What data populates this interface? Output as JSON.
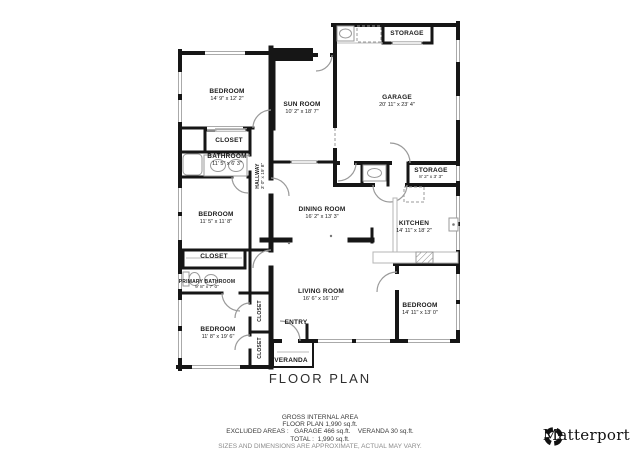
{
  "title": "FLOOR PLAN",
  "rooms": [
    {
      "name": "BEDROOM",
      "dims": "14' 9\" x 12' 2\""
    },
    {
      "name": "SUN ROOM",
      "dims": "10' 2\" x 18' 7\""
    },
    {
      "name": "GARAGE",
      "dims": "20' 11\" x 23' 4\""
    },
    {
      "name": "STORAGE",
      "dims": ""
    },
    {
      "name": "CLOSET",
      "dims": ""
    },
    {
      "name": "BATHROOM",
      "dims": "11' 5\" x 6' 3\""
    },
    {
      "name": "HALLWAY",
      "dims": "3' 0\" x 19' 8\""
    },
    {
      "name": "BEDROOM",
      "dims": "11' 5\" x 11' 8\""
    },
    {
      "name": "DINING ROOM",
      "dims": "16' 2\" x 13' 3\""
    },
    {
      "name": "KITCHEN",
      "dims": "14' 11\" x 18' 2\""
    },
    {
      "name": "STORAGE",
      "dims": "8' 2\" x 3' 3\""
    },
    {
      "name": "CLOSET",
      "dims": ""
    },
    {
      "name": "PRIMARY BATHROOM",
      "dims": "9' 8\" x 7' 0\""
    },
    {
      "name": "BEDROOM",
      "dims": "11' 8\" x 19' 6\""
    },
    {
      "name": "CLOSET",
      "dims": ""
    },
    {
      "name": "CLOSET",
      "dims": ""
    },
    {
      "name": "LIVING ROOM",
      "dims": "16' 6\" x 16' 10\""
    },
    {
      "name": "ENTRY",
      "dims": ""
    },
    {
      "name": "BEDROOM",
      "dims": "14' 11\" x 13' 0\""
    },
    {
      "name": "VERANDA",
      "dims": ""
    }
  ],
  "footer": {
    "gross_heading": "GROSS INTERNAL AREA",
    "floor_plan_area": "FLOOR PLAN 1,990 sq.ft.",
    "excluded": "EXCLUDED AREAS :   GARAGE 466 sq.ft.    VERANDA 30 sq.ft.",
    "total": "TOTAL :  1,990 sq.ft.",
    "disclaimer": "SIZES AND DIMENSIONS ARE APPROXIMATE, ACTUAL MAY VARY."
  },
  "branding": {
    "logo_text": "Matterport"
  },
  "colors": {
    "wall": "#161616",
    "window": "#aaaaaa",
    "fixture": "#999999",
    "text": "#1b1b1b"
  }
}
